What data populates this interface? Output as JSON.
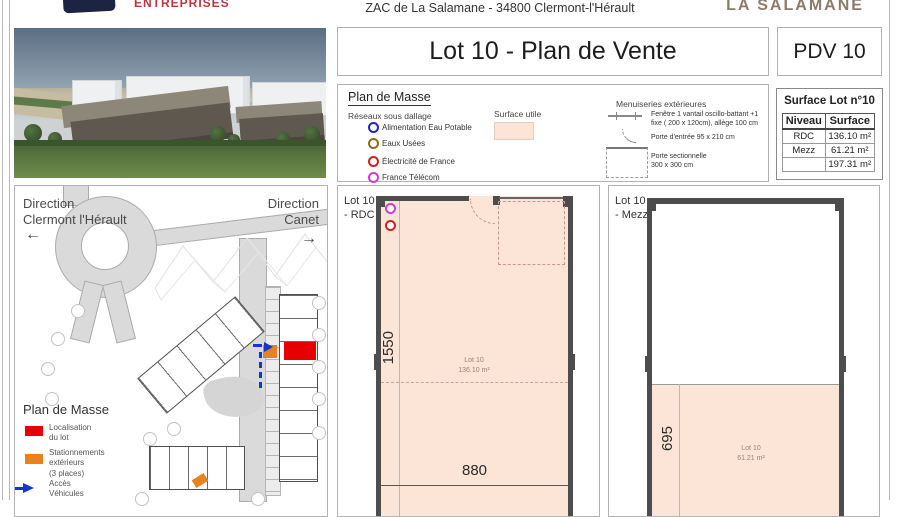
{
  "header": {
    "logo_text": "ENTREPRISES",
    "address": "ZAC de La Salamane - 34800 Clermont-l'Hérault",
    "brand": "LA SALAMANE"
  },
  "title_block": {
    "title": "Lot 10 - Plan de Vente",
    "reference": "PDV 10"
  },
  "legend": {
    "title": "Plan de Masse",
    "networks_heading": "Réseaux sous dallage",
    "networks": [
      {
        "label": "Alimentation Eau Potable",
        "color": "#2323b5"
      },
      {
        "label": "Eaux Usées",
        "color": "#8a6d1f"
      },
      {
        "label": "Électricité de France",
        "color": "#cc2222"
      },
      {
        "label": "France Télécom",
        "color": "#d23bd2"
      }
    ],
    "surface_utile": {
      "label": "Surface utile",
      "color": "#fce5d6"
    },
    "menuiseries_heading": "Menuiseries extérieures",
    "menuiseries": [
      {
        "label": "Fenêtre 1 vantail oscillo-battant +1\nfixe ( 200 x 120cm), allège 100 cm"
      },
      {
        "label": "Porte d'entrée 95 x 210 cm"
      },
      {
        "label": "Porte sectionnelle\n300 x 300 cm"
      }
    ]
  },
  "surface_table": {
    "title": "Surface Lot n°10",
    "columns": [
      "Niveau",
      "Surface"
    ],
    "rows": [
      {
        "niveau": "RDC",
        "surface": "136.10 m²"
      },
      {
        "niveau": "Mezz",
        "surface": "61.21 m²"
      },
      {
        "niveau": "",
        "surface": "197.31 m²"
      }
    ]
  },
  "site_map": {
    "direction_left": "Direction\nClermont l'Hérault",
    "direction_right": "Direction\nCanet",
    "legend_title": "Plan de Masse",
    "legend_items": [
      {
        "label": "Localisation\ndu lot",
        "color": "#e60000"
      },
      {
        "label": "Stationnements\nextérieurs\n(3 places)",
        "color": "#e8821e"
      },
      {
        "label": "Accès\nVéhicules",
        "color": "#1535cc"
      }
    ]
  },
  "floor_plans": {
    "rdc": {
      "panel_label": "Lot 10\n- RDC",
      "lot": "Lot 10",
      "area": "136.10 m²",
      "height_dim": "1550",
      "width_dim": "880"
    },
    "mezz": {
      "panel_label": "Lot 10\n- Mezz",
      "lot": "Lot 10",
      "area": "61.21 m²",
      "height_dim": "695"
    }
  },
  "colors": {
    "surface_fill": "#fce5d6",
    "wall": "#4d4d4d",
    "lot_red": "#e60000",
    "parking_orange": "#e8821e",
    "access_blue": "#1535cc"
  }
}
